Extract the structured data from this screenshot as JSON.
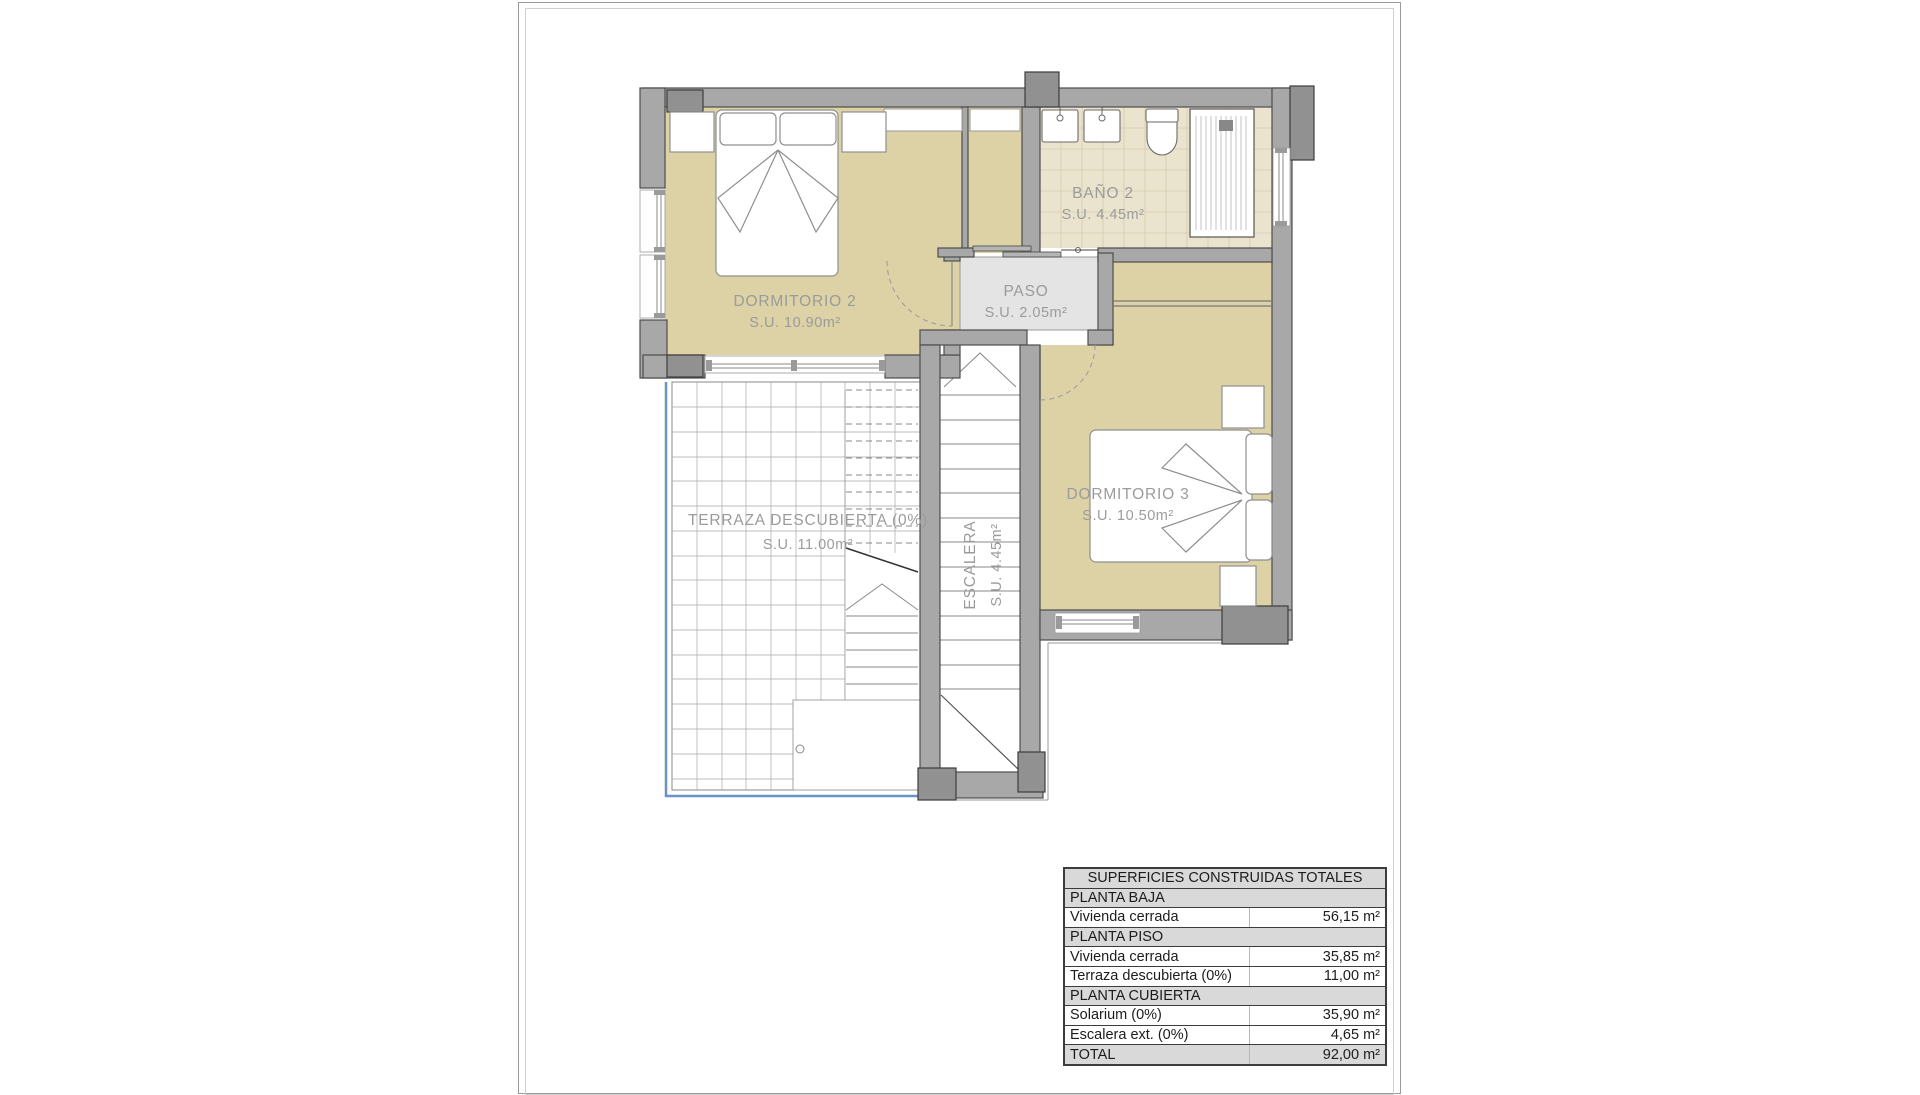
{
  "document": {
    "type": "floor-plan-sheet",
    "floor": "planta piso (upper floor)"
  },
  "plan": {
    "rooms": {
      "dormitorio2": {
        "name": "DORMITORIO 2",
        "area": "S.U. 10.90m²"
      },
      "bano2": {
        "name": "BAÑO 2",
        "area": "S.U. 4.45m²"
      },
      "paso": {
        "name": "PASO",
        "area": "S.U. 2.05m²"
      },
      "dormitorio3": {
        "name": "DORMITORIO 3",
        "area": "S.U. 10.50m²"
      },
      "terraza": {
        "name": "TERRAZA DESCUBIERTA (0%)",
        "area": "S.U. 11.00m²"
      },
      "escalera": {
        "name": "ESCALERA",
        "area": "S.U. 4.45m²"
      }
    },
    "colors": {
      "floor_tan": "#ddd1a6",
      "bath_tile": "#eae3cd",
      "paso_gray": "#e4e4e4",
      "wall_gray": "#a8a8a8",
      "pillar_gray": "#919191",
      "railing_blue": "#6b93c8",
      "label_gray": "#9b9b9b"
    }
  },
  "table": {
    "rows": [
      {
        "type": "header",
        "label": "SUPERFICIES CONSTRUIDAS TOTALES",
        "value": ""
      },
      {
        "type": "section",
        "label": "PLANTA BAJA",
        "value": ""
      },
      {
        "type": "data",
        "label": "Vivienda cerrada",
        "value": "56,15 m²"
      },
      {
        "type": "section",
        "label": "PLANTA PISO",
        "value": ""
      },
      {
        "type": "data",
        "label": "Vivienda cerrada",
        "value": "35,85 m²"
      },
      {
        "type": "data",
        "label": "Terraza descubierta (0%)",
        "value": "11,00 m²"
      },
      {
        "type": "section",
        "label": "PLANTA CUBIERTA",
        "value": ""
      },
      {
        "type": "data",
        "label": "Solarium (0%)",
        "value": "35,90 m²"
      },
      {
        "type": "data",
        "label": "Escalera ext. (0%)",
        "value": "4,65 m²"
      },
      {
        "type": "total",
        "label": "TOTAL",
        "value": "92,00 m²"
      }
    ]
  }
}
